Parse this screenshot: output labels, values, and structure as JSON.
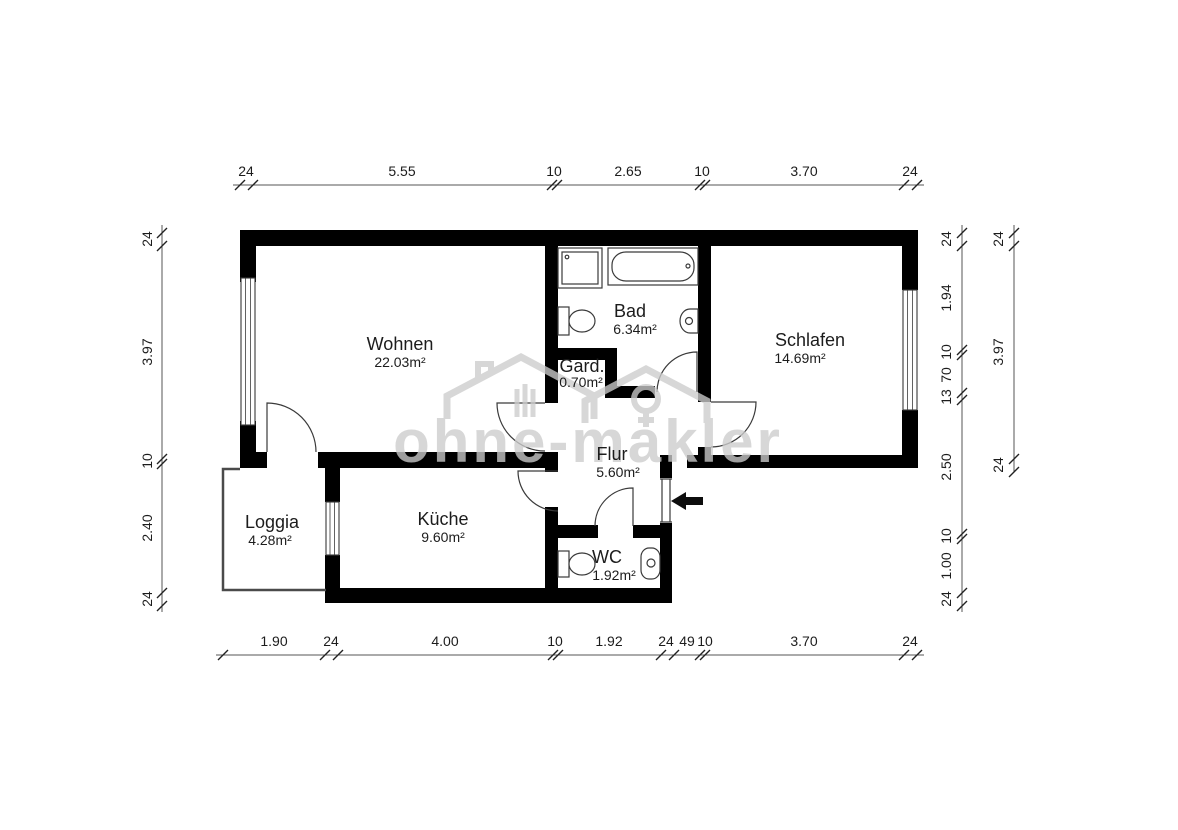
{
  "watermark": {
    "text": "ohne-makler",
    "logo": "house-logo",
    "color": "#cccccc"
  },
  "rooms": [
    {
      "id": "wohnen",
      "name": "Wohnen",
      "area": "22.03m²"
    },
    {
      "id": "bad",
      "name": "Bad",
      "area": "6.34m²"
    },
    {
      "id": "schlafen",
      "name": "Schlafen",
      "area": "14.69m²"
    },
    {
      "id": "gard",
      "name": "Gard.",
      "area": "0.70m²"
    },
    {
      "id": "flur",
      "name": "Flur",
      "area": "5.60m²"
    },
    {
      "id": "kueche",
      "name": "Küche",
      "area": "9.60m²"
    },
    {
      "id": "loggia",
      "name": "Loggia",
      "area": "4.28m²"
    },
    {
      "id": "wc",
      "name": "WC",
      "area": "1.92m²"
    }
  ],
  "dimensions": {
    "top": [
      "24",
      "5.55",
      "10",
      "2.65",
      "10",
      "3.70",
      "24"
    ],
    "bottom": [
      "1.90",
      "24",
      "4.00",
      "10",
      "1.92",
      "24",
      "49",
      "10",
      "3.70",
      "24"
    ],
    "left": [
      "24",
      "3.97",
      "10",
      "2.40",
      "24"
    ],
    "right_inner": [
      "24",
      "1.94",
      "10",
      "70",
      "13",
      "2.50",
      "10",
      "1.00",
      "24"
    ],
    "right_outer": [
      "24",
      "3.97",
      "24"
    ]
  },
  "fixtures": [
    "shower",
    "bathtub",
    "toilet-bad",
    "sink-bad",
    "toilet-wc",
    "sink-wc"
  ],
  "entrance": {
    "symbol": "entry-arrow-left"
  },
  "colors": {
    "wall": "#000000",
    "line": "#3a3a3a",
    "watermark": "#cccccc",
    "background": "#ffffff"
  }
}
